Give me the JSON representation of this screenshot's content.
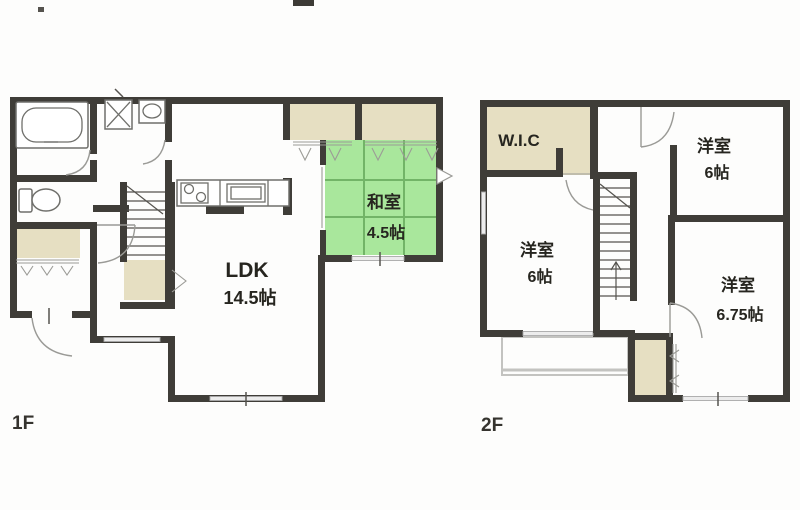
{
  "plan": {
    "floor1": {
      "label": "1F",
      "rooms": {
        "ldk": {
          "name": "LDK",
          "size": "14.5帖"
        },
        "washitsu": {
          "name": "和室",
          "size": "4.5帖"
        }
      }
    },
    "floor2": {
      "label": "2F",
      "rooms": {
        "wic": {
          "name": "W.I.C"
        },
        "bedroom_top": {
          "name": "洋室",
          "size": "6帖"
        },
        "bedroom_left": {
          "name": "洋室",
          "size": "6帖"
        },
        "bedroom_right": {
          "name": "洋室",
          "size": "6.75帖"
        }
      }
    },
    "colors": {
      "wall": "#3f3d38",
      "tatami_green": "#a9e79c",
      "tatami_line": "#72b467",
      "closet_tan": "#e6dfc2",
      "window_gray": "#ececec"
    }
  }
}
